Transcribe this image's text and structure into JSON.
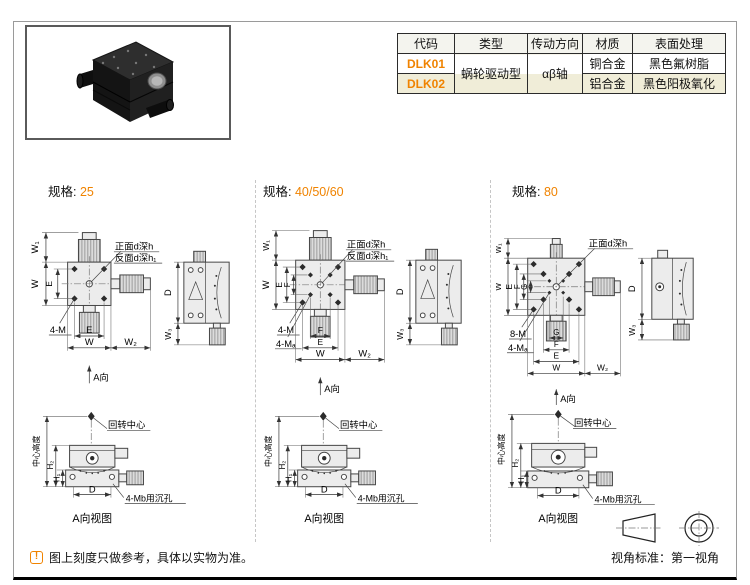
{
  "accent_color": "#f08300",
  "row_alt_color": "#f0edd8",
  "table": {
    "headers": [
      "代码",
      "类型",
      "传动方向",
      "材质",
      "表面处理"
    ],
    "merged_type": "蜗轮驱动型",
    "merged_direction": "αβ轴",
    "rows": [
      {
        "code": "DLK01",
        "material": "铜合金",
        "finish": "黑色氟树脂"
      },
      {
        "code": "DLK02",
        "material": "铝合金",
        "finish": "黑色阳极氧化"
      }
    ]
  },
  "sections": [
    {
      "heading_label": "规格:",
      "heading_value": "25",
      "top": {
        "w1": "W₁",
        "w": "W",
        "e": "E",
        "leader_front": "正面d深h",
        "leader_back": "反面d深h₁",
        "thread_outer": "4-M",
        "dim_e": "E",
        "dim_w": "W",
        "dim_w2": "W₂",
        "view_arrow": "A向"
      },
      "side": {
        "d": "D",
        "w3": "W₃"
      },
      "aview": {
        "center_height": "中心高度",
        "rotation_center": "回转中心",
        "h2": "H₂",
        "h1": "H₁",
        "dim_d": "D",
        "counterbore": "4-Mb用沉孔",
        "caption": "A向视图"
      }
    },
    {
      "heading_label": "规格:",
      "heading_value": "40/50/60",
      "top": {
        "w1": "W₁",
        "w": "W",
        "e": "E",
        "f": "F",
        "leader_front": "正面d深h",
        "leader_back": "反面d深h₁",
        "thread_outer": "4-M",
        "thread_inner": "4-Mₐ",
        "dim_f": "F",
        "dim_e": "E",
        "dim_w": "W",
        "dim_w2": "W₂",
        "view_arrow": "A向"
      },
      "side": {
        "d": "D",
        "w3": "W₃"
      },
      "aview": {
        "center_height": "中心高度",
        "rotation_center": "回转中心",
        "h2": "H₂",
        "h1": "H₁",
        "dim_d": "D",
        "counterbore": "4-Mb用沉孔",
        "caption": "A向视图"
      }
    },
    {
      "heading_label": "规格:",
      "heading_value": "80",
      "top": {
        "w1": "W₁",
        "w": "W",
        "e": "E",
        "f": "F",
        "g": "G",
        "leader_front": "正面d深h",
        "thread_outer": "8-M",
        "thread_inner": "4-Mₐ",
        "dim_g": "G",
        "dim_f": "F",
        "dim_e": "E",
        "dim_w": "W",
        "dim_w2": "W₂",
        "view_arrow": "A向"
      },
      "side": {
        "d": "D",
        "w3": "W₃"
      },
      "aview": {
        "center_height": "中心高度",
        "rotation_center": "回转中心",
        "h2": "H₂",
        "h1": "H₁",
        "dim_d": "D",
        "counterbore": "4-Mb用沉孔",
        "caption": "A向视图"
      }
    }
  ],
  "footer": {
    "note_icon": "!",
    "note": "图上刻度只做参考，具体以实物为准。",
    "view_standard": "视角标准：第一视角"
  }
}
